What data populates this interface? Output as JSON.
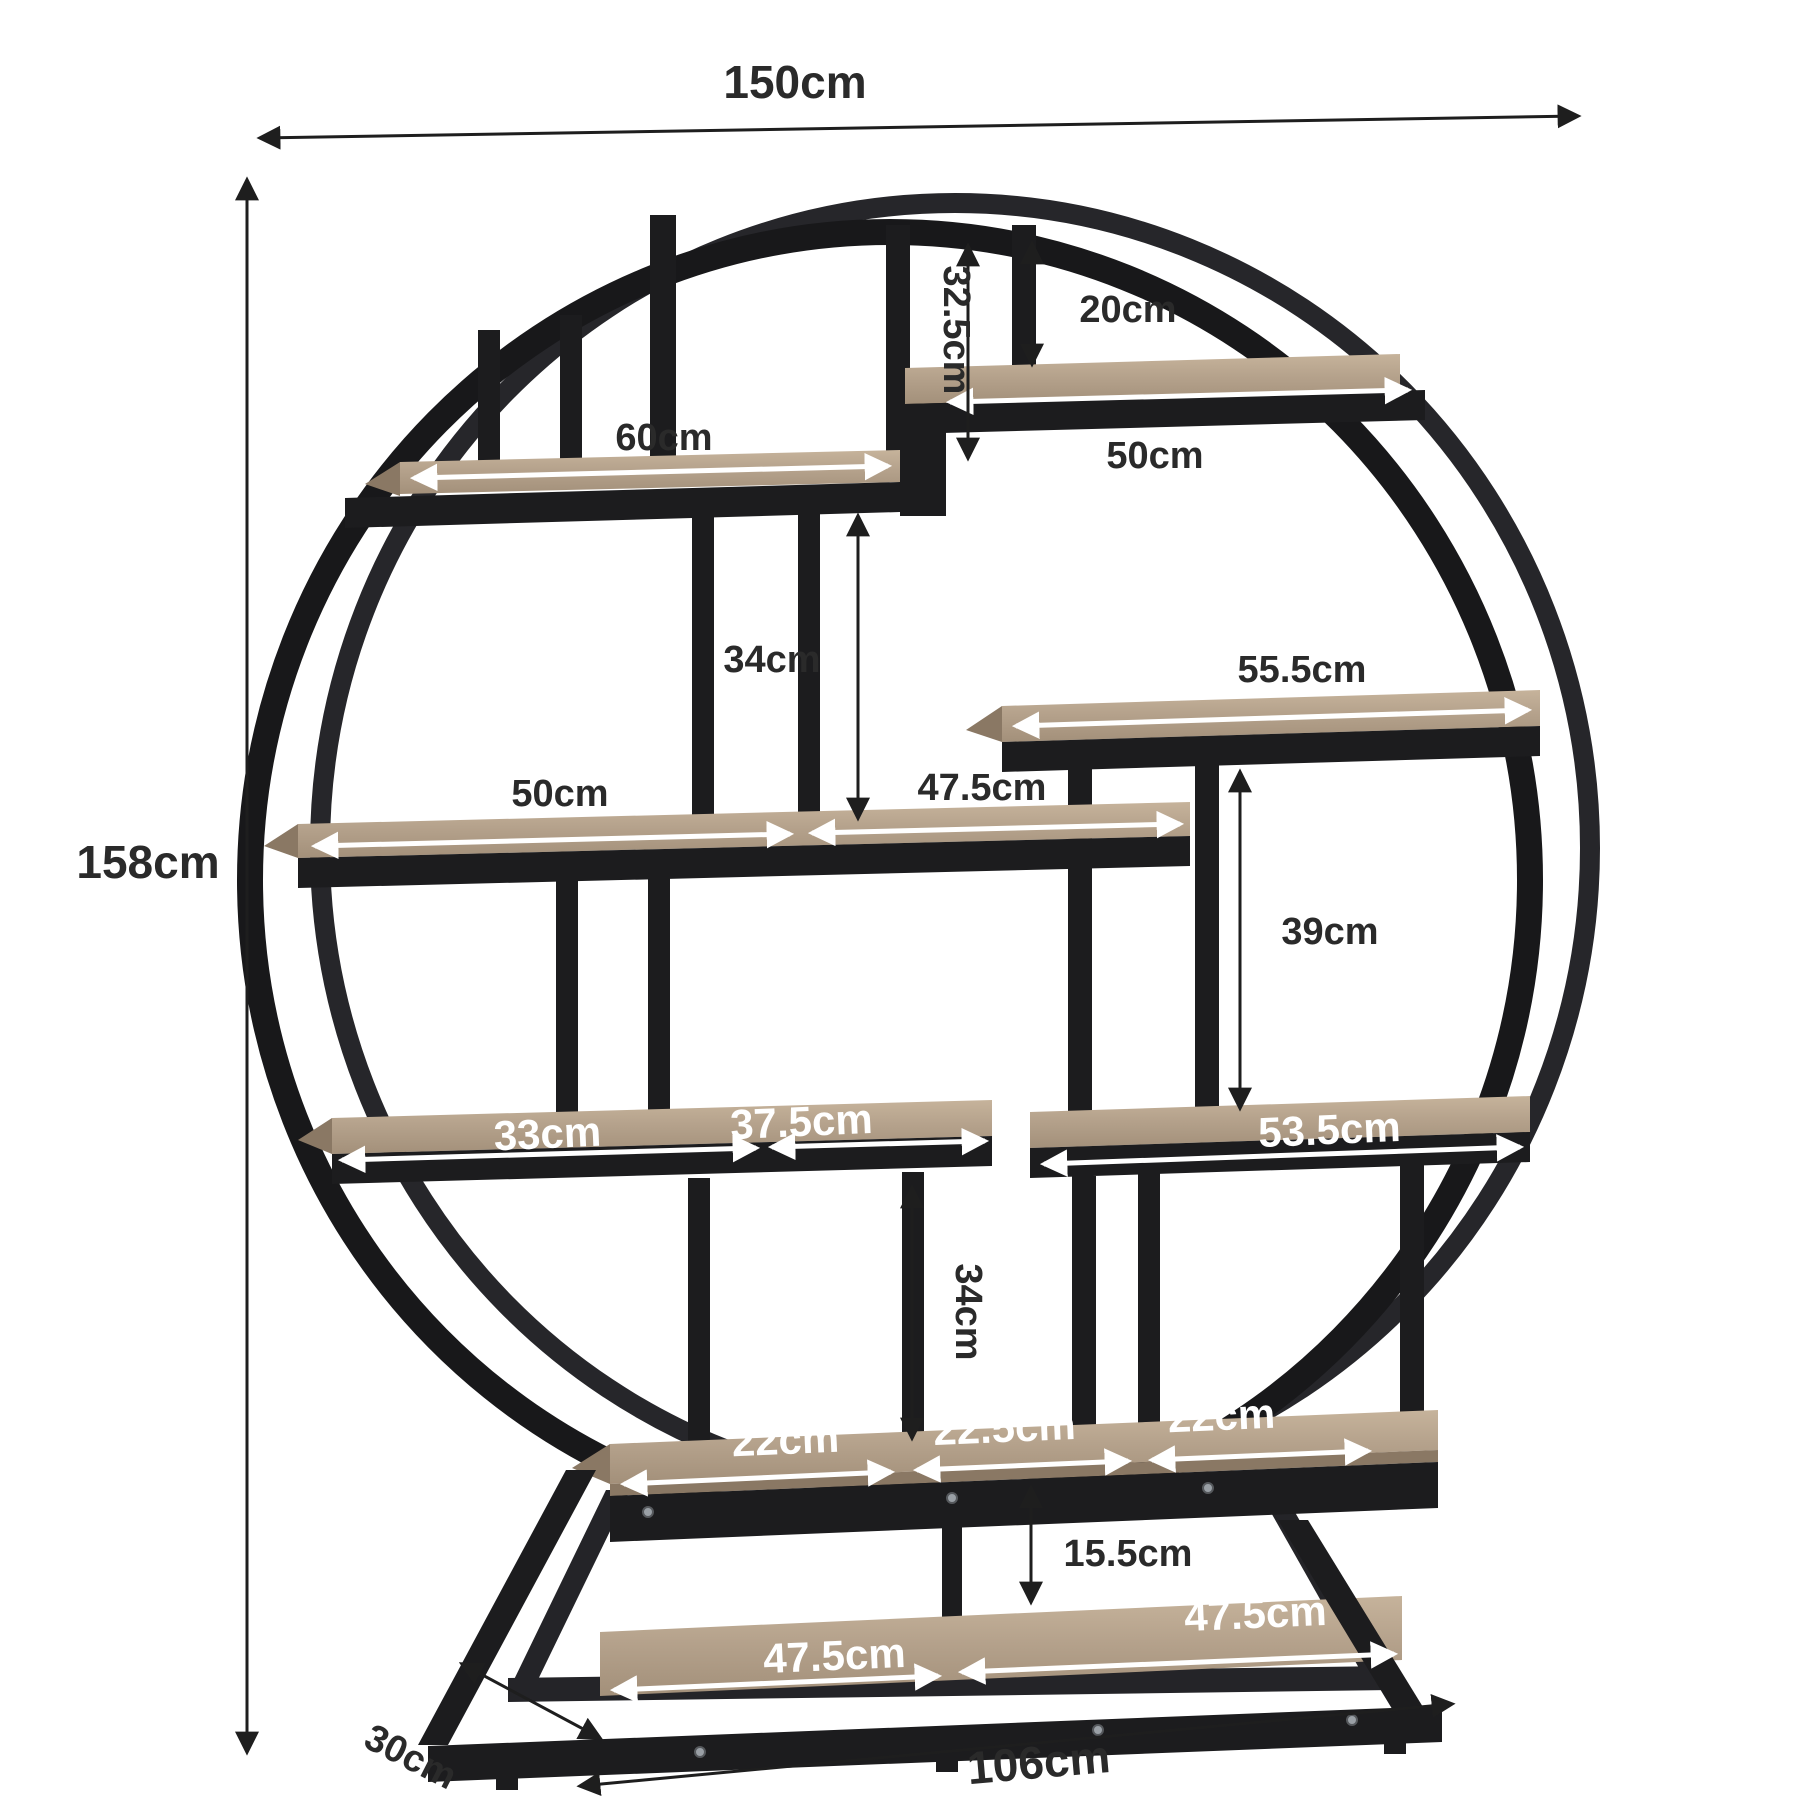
{
  "diagram": {
    "subject": "round-etagere-bookshelf-dimension-diagram",
    "units": "cm"
  },
  "colors": {
    "background": "#ffffff",
    "frame_metal": "#1c1c1e",
    "wood": "#b5a28c",
    "wood_edge": "#8a7864",
    "dimension_line": "#1e1e1e",
    "label_dark": "#2a2a2a",
    "label_light": "#ffffff"
  },
  "dimensions": {
    "overall_width": "150cm",
    "overall_height": "158cm",
    "overall_depth": "30cm",
    "base_width": "106cm",
    "top_gap": "32.5cm",
    "top_shelf_clearance": "20cm",
    "upper_left_shelf": "60cm",
    "top_right_shelf": "50cm",
    "upper_mid_gap": "34cm",
    "right_shelf": "55.5cm",
    "mid_shelf_left": "50cm",
    "mid_shelf_right": "47.5cm",
    "right_gap": "39cm",
    "lower_left_shelf_left": "33cm",
    "lower_left_shelf_right": "37.5cm",
    "lower_right_shelf": "53.5cm",
    "lower_mid_gap": "34cm",
    "bottom_shelf_left": "22cm",
    "bottom_shelf_mid": "22.5cm",
    "bottom_shelf_right": "22cm",
    "base_gap": "15.5cm",
    "base_shelf_left": "47.5cm",
    "base_shelf_right": "47.5cm"
  }
}
